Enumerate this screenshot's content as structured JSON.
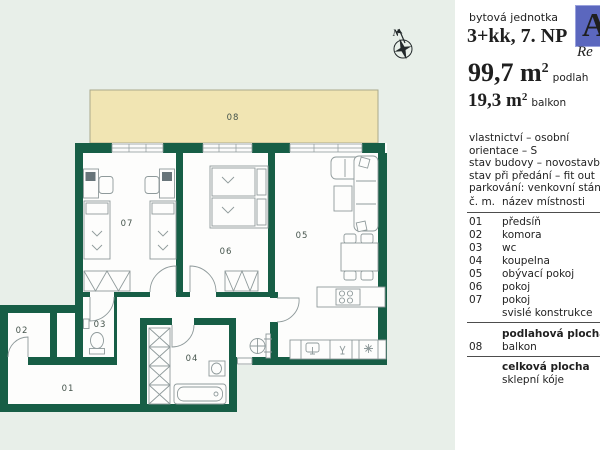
{
  "colors": {
    "background": "#e8efe9",
    "wall": "#175e46",
    "balcony": "#f1e5b3",
    "balcony_border": "#aaa98b",
    "furniture": "#8f9a9b",
    "label": "#45544c",
    "logo_blue": "#5b67be",
    "logo_script": "#b49c9c"
  },
  "panel": {
    "unit_label": "bytová jednotka",
    "unit_type": "3+kk, 7. NP",
    "logo": {
      "letter": "A",
      "script": "Re"
    },
    "area_floor": {
      "value": "99,7 m",
      "sup": "2",
      "suffix": "podlah"
    },
    "area_balcony": {
      "value": "19,3 m",
      "sup": "2",
      "suffix": "balkon"
    },
    "details": [
      "vlastnictví – osobní",
      "orientace – S",
      "stav budovy – novostavba",
      "stav při předání – fit out",
      "parkování: venkovní stání, v c"
    ],
    "table": {
      "header": {
        "num": "č. m.",
        "name": "název místnosti"
      },
      "rows": [
        {
          "num": "01",
          "name": "předsíň"
        },
        {
          "num": "02",
          "name": "komora"
        },
        {
          "num": "03",
          "name": "wc"
        },
        {
          "num": "04",
          "name": "koupelna"
        },
        {
          "num": "05",
          "name": "obývací pokoj"
        },
        {
          "num": "06",
          "name": "pokoj"
        },
        {
          "num": "07",
          "name": "pokoj"
        },
        {
          "num": "",
          "name": "svislé konstrukce"
        }
      ],
      "floor_total_label": "podlahová plocha",
      "balcony_row": {
        "num": "08",
        "name": "balkon"
      },
      "total_label": "celková plocha",
      "cellar_label": "sklepní kóje"
    }
  },
  "plan": {
    "compass_label": "N",
    "rooms": [
      {
        "id": "01",
        "label": "01",
        "x": 68,
        "y": 391
      },
      {
        "id": "02",
        "label": "02",
        "x": 22,
        "y": 333
      },
      {
        "id": "03",
        "label": "03",
        "x": 100,
        "y": 327
      },
      {
        "id": "04",
        "label": "04",
        "x": 192,
        "y": 361
      },
      {
        "id": "05",
        "label": "05",
        "x": 302,
        "y": 238
      },
      {
        "id": "06",
        "label": "06",
        "x": 226,
        "y": 254
      },
      {
        "id": "07",
        "label": "07",
        "x": 127,
        "y": 226
      },
      {
        "id": "08",
        "label": "08",
        "x": 233,
        "y": 120
      }
    ]
  }
}
